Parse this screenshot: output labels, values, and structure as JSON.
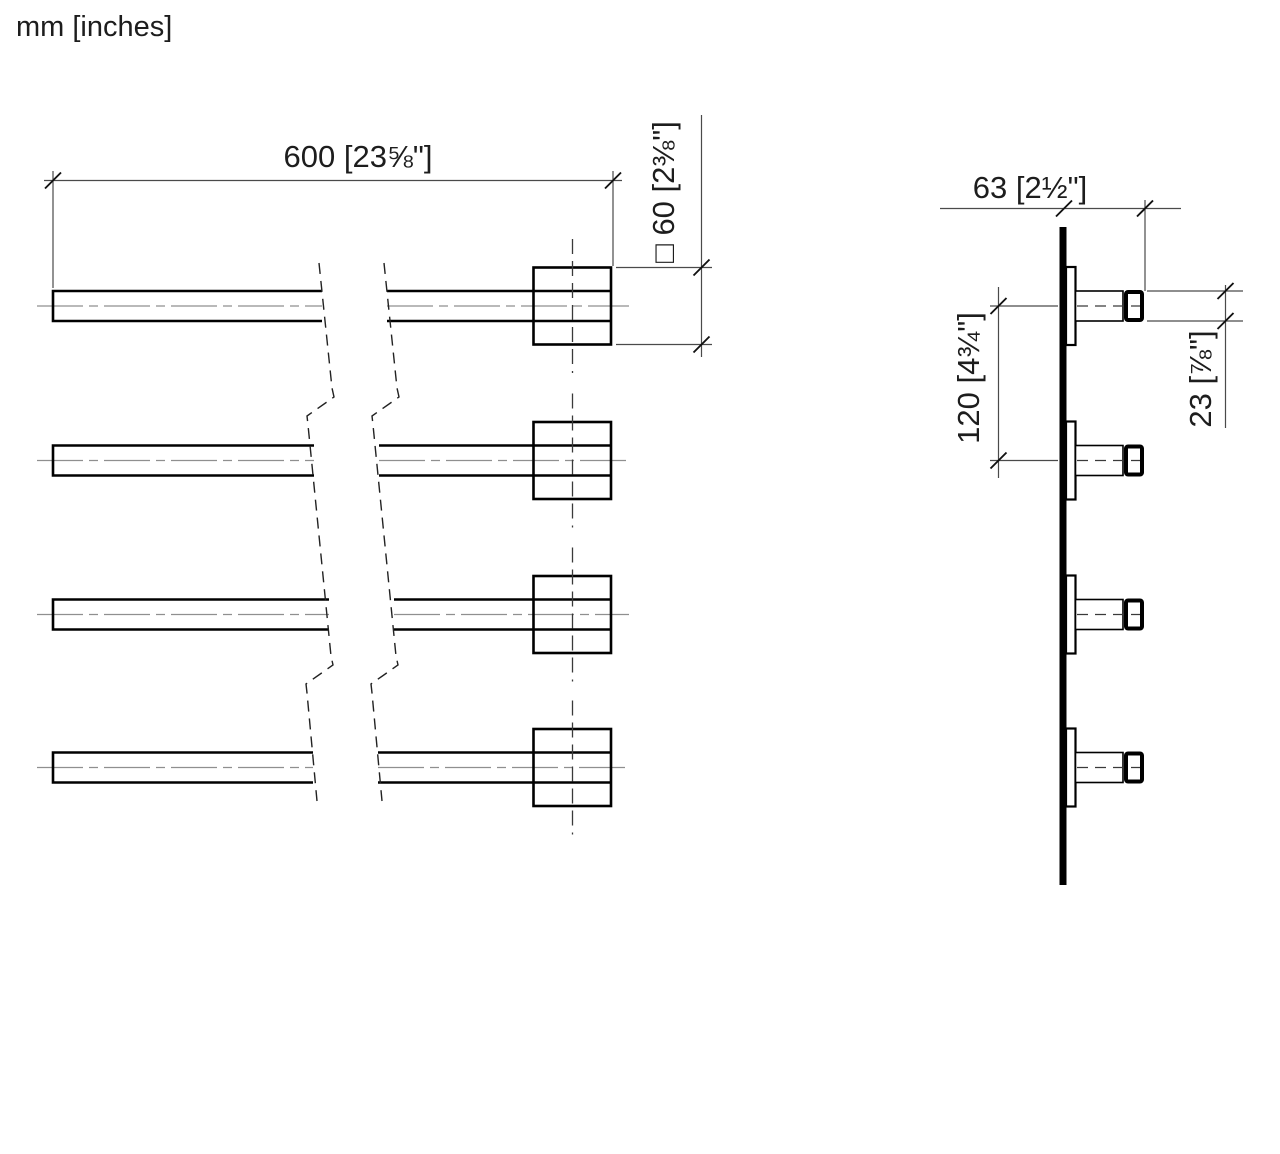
{
  "units_label": "mm [inches]",
  "front_view": {
    "description": "front view, 4 towel bars with wall blocks",
    "length_dim": "600 [23⅝\"]",
    "profile_dim": "□ 60 [2⅜\"]",
    "bar_count": 4
  },
  "side_view": {
    "description": "side view, wall rail with 4 projecting bars",
    "projection_dim": "63 [2½\"]",
    "spacing_dim": "120 [4¾\"]",
    "bar_height_dim": "23 [⅞\"]"
  },
  "colors": {
    "line": "#000000",
    "centerline": "#8f8f8f",
    "background": "#ffffff"
  }
}
